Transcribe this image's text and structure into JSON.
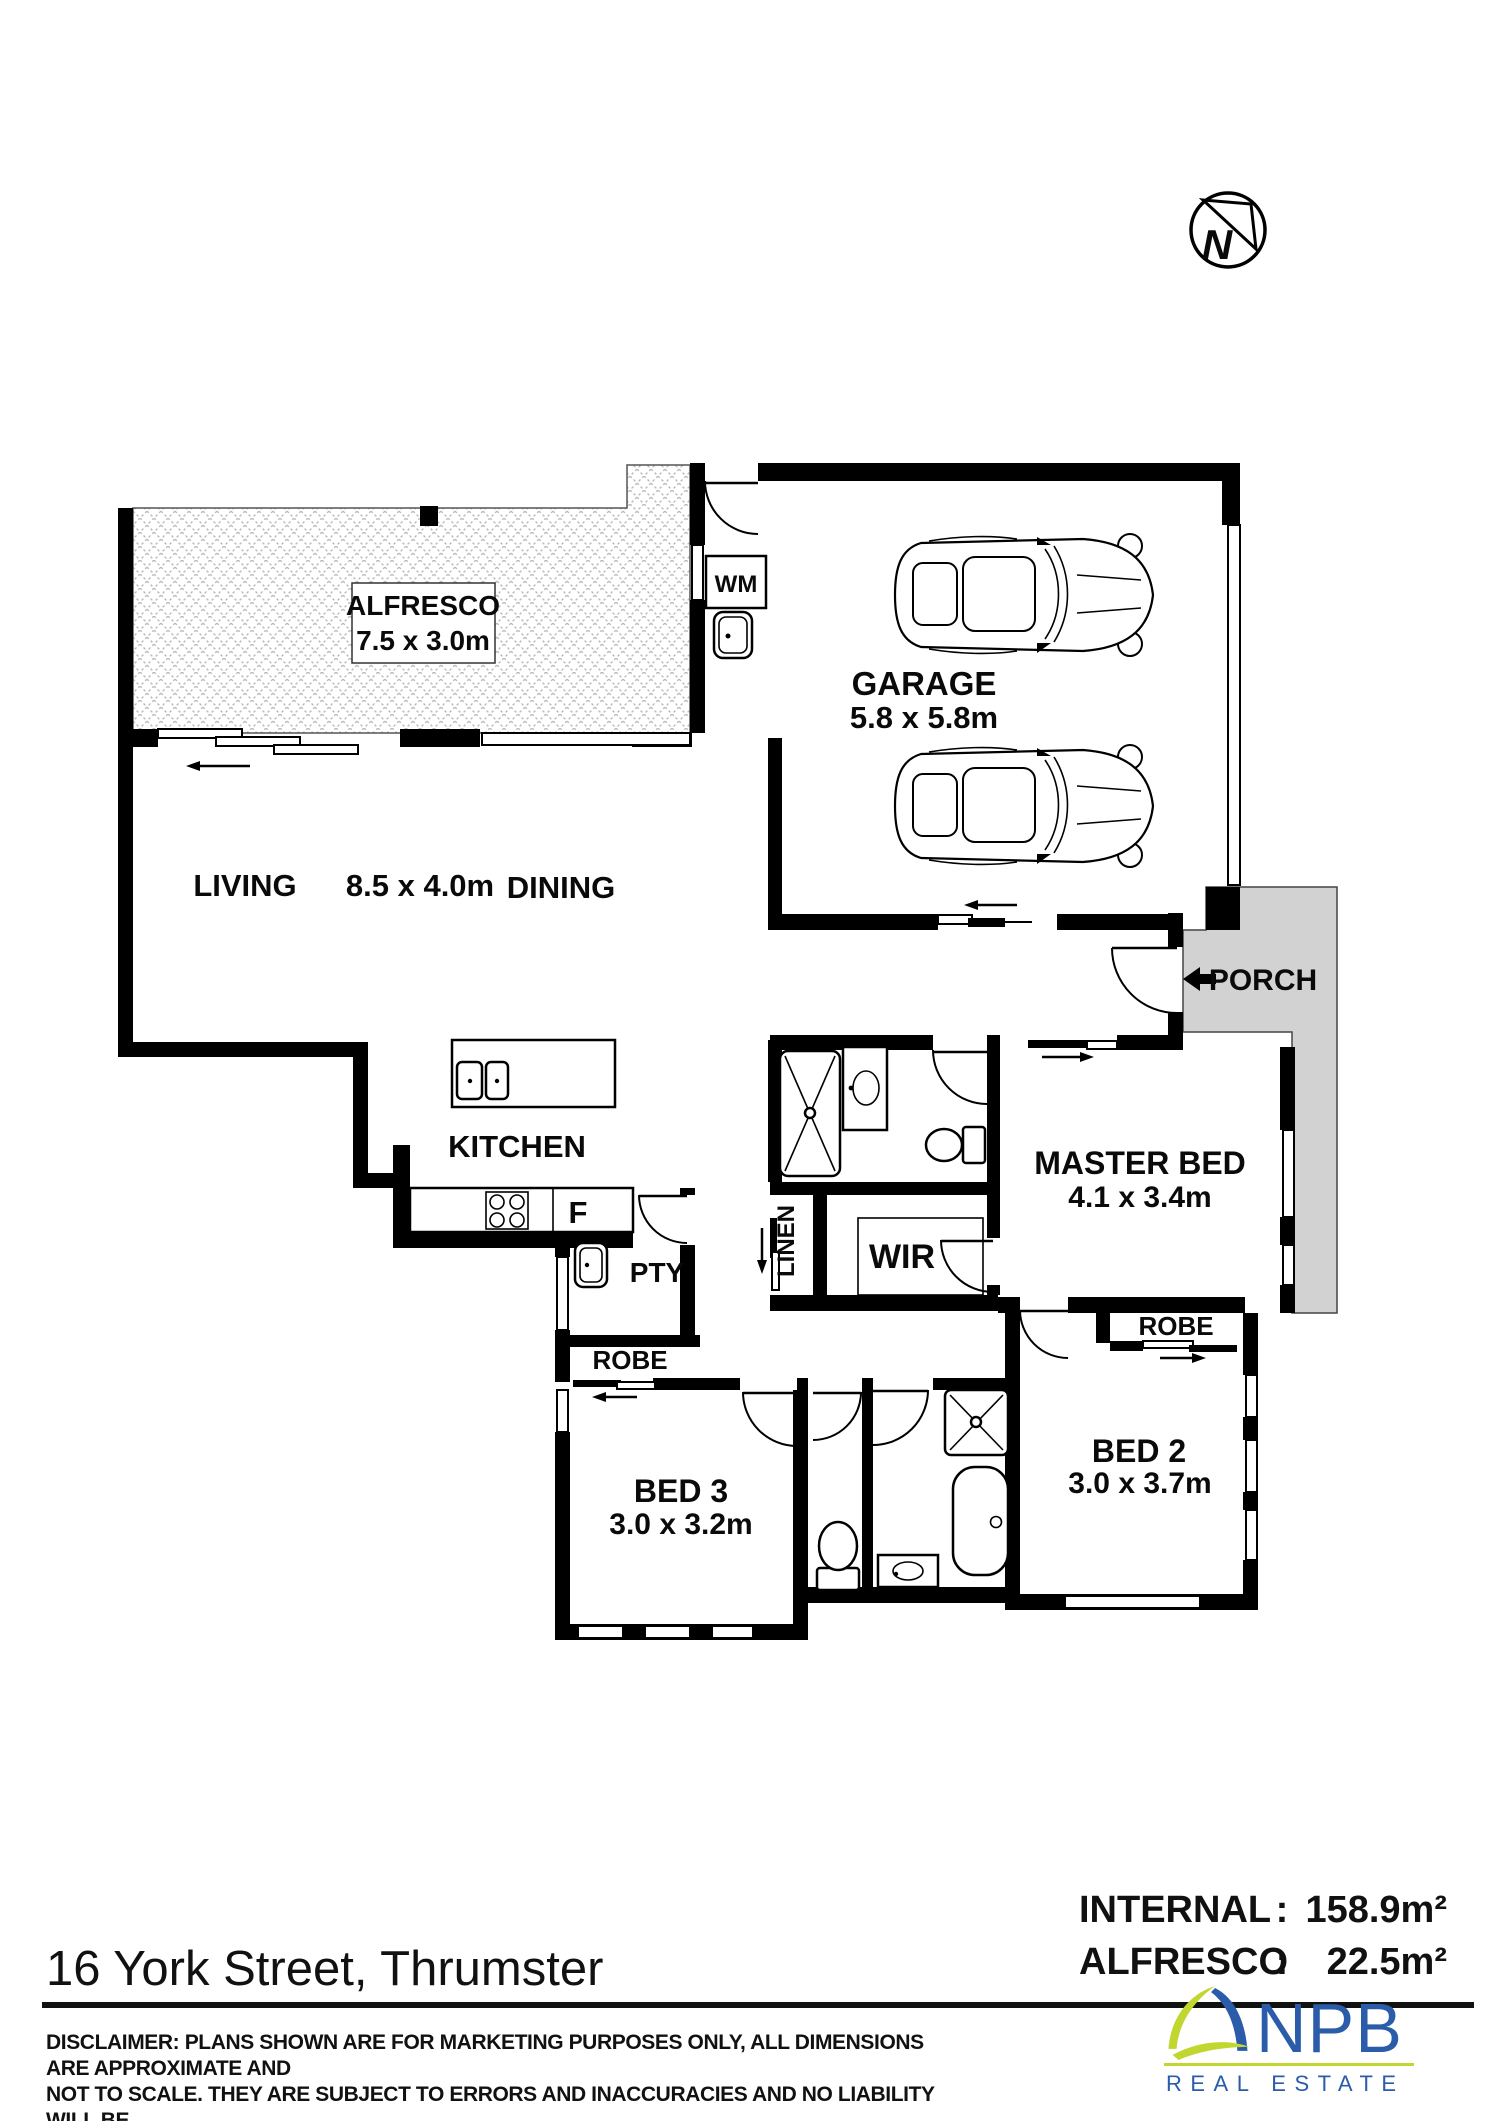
{
  "compass": {
    "label": "N"
  },
  "plan": {
    "alfresco": {
      "label": "ALFRESCO",
      "dims": "7.5 x 3.0m"
    },
    "garage": {
      "label": "GARAGE",
      "dims": "5.8 x 5.8m"
    },
    "living": {
      "label": "LIVING"
    },
    "living_dining_dims": "8.5 x 4.0m",
    "dining": {
      "label": "DINING"
    },
    "kitchen": {
      "label": "KITCHEN"
    },
    "fridge": {
      "label": "F"
    },
    "pantry": {
      "label": "PTY"
    },
    "laundry": {
      "label": "WM"
    },
    "linen": {
      "label": "LINEN"
    },
    "wir": {
      "label": "WIR"
    },
    "porch": {
      "label": "PORCH"
    },
    "master_bed": {
      "label": "MASTER BED",
      "dims": "4.1 x 3.4m"
    },
    "bed2": {
      "label": "BED 2",
      "dims": "3.0 x 3.7m"
    },
    "bed3": {
      "label": "BED 3",
      "dims": "3.0 x 3.2m"
    },
    "robe_bed2": {
      "label": "ROBE"
    },
    "robe_bed3": {
      "label": "ROBE"
    }
  },
  "footer": {
    "address": "16 York Street, Thrumster",
    "areas": [
      {
        "label": "INTERNAL",
        "colon": ":",
        "value": "158.9m²"
      },
      {
        "label": "ALFRESCO",
        "colon": ":",
        "value": "22.5m²"
      }
    ],
    "disclaimer_lines": [
      "DISCLAIMER: PLANS SHOWN ARE FOR MARKETING PURPOSES ONLY, ALL DIMENSIONS ARE APPROXIMATE AND",
      "NOT TO SCALE. THEY ARE SUBJECT TO ERRORS AND INACCURACIES AND NO LIABILITY WILL BE",
      "ACCEPTED. INTERESTED PARTIES SHOULD MAKE THEIR OWN INQUIRES."
    ],
    "logo": {
      "name": "NPB",
      "tagline": "REAL ESTATE"
    }
  },
  "colors": {
    "wall_black": "#000000",
    "porch_gray": "#d2d2d2",
    "hatch_gray": "#bbbbbb",
    "logo_blue": "#2a5caa",
    "logo_green": "#c1d62f"
  }
}
